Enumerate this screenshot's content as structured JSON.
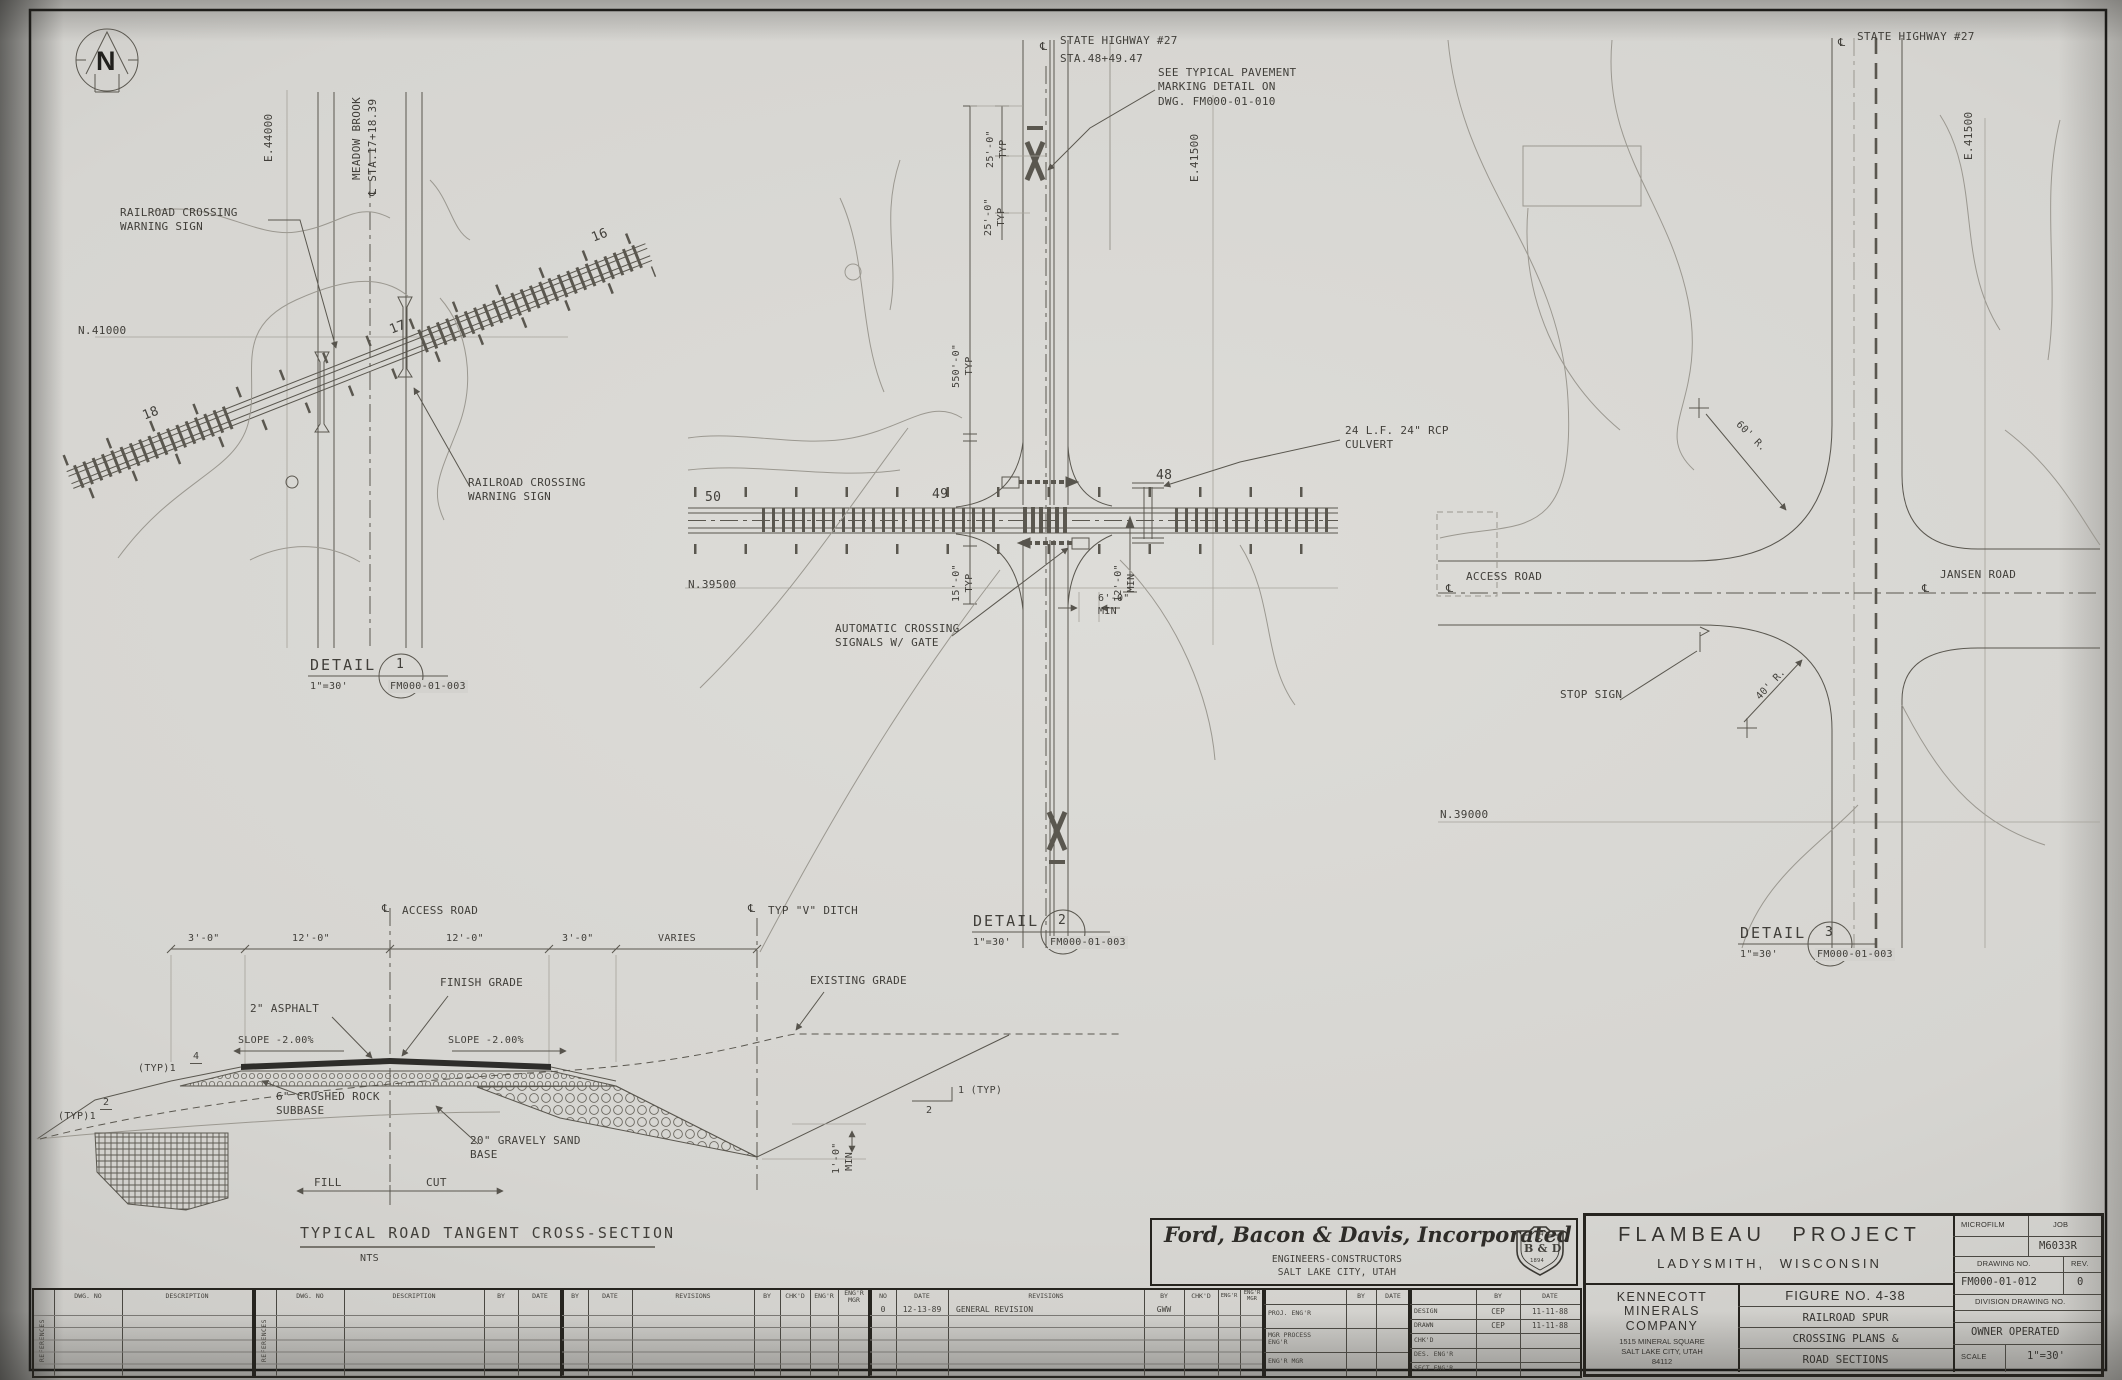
{
  "sheet": {
    "north_letter": "N"
  },
  "d1": {
    "grid_e": "E.44000",
    "grid_n": "N.41000",
    "brook": "MEADOW BROOK",
    "brook_sta": "STA.17+18.39",
    "warn": "RAILROAD CROSSING\nWARNING SIGN",
    "warn2": "RAILROAD CROSSING\nWARNING SIGN",
    "sta18": "18",
    "sta17": "17",
    "sta16": "16"
  },
  "d2": {
    "hwy": "STATE HIGHWAY #27",
    "hwy_sta": "STA.48+49.47",
    "note": "SEE TYPICAL PAVEMENT\nMARKING DETAIL ON\nDWG. FM000-01-010",
    "dim25a": "25'-0\"\nTYP",
    "dim25b": "25'-0\"\nTYP",
    "grid_e": "E.41500",
    "grid_n": "N.39500",
    "dim550": "550'-0\"\nTYP",
    "dim15": "15'-0\"\nTYP",
    "dim12": "12'-0\"\nMIN",
    "dim6": "6'-0\"\nMIN",
    "culvert": "24 L.F. 24\" RCP\nCULVERT",
    "signals": "AUTOMATIC CROSSING\nSIGNALS W/ GATE",
    "sta50": "50",
    "sta49": "49",
    "sta48": "48"
  },
  "d3": {
    "hwy": "STATE HIGHWAY #27",
    "grid_e": "E.41500",
    "grid_n": "N.39000",
    "r60": "60' R.",
    "r40": "40' R.",
    "access": "ACCESS ROAD",
    "jansen": "JANSEN ROAD",
    "stop": "STOP SIGN"
  },
  "xs": {
    "cl_access": "ACCESS ROAD",
    "cl_ditch": "TYP \"V\" DITCH",
    "dim1": "3'-0\"",
    "dim2": "12'-0\"",
    "dim3": "12'-0\"",
    "dim4": "3'-0\"",
    "dim5": "VARIES",
    "finish": "FINISH GRADE",
    "asphalt": "2\" ASPHALT",
    "slope_l": "SLOPE -2.00%",
    "slope_r": "SLOPE -2.00%",
    "typ4_label": "(TYP)1",
    "typ4_num": "4",
    "typ2_label": "(TYP)1",
    "typ2_num": "2",
    "subbase": "6\" CRUSHED ROCK\nSUBBASE",
    "base": "20\" GRAVELY SAND\nBASE",
    "fill": "FILL",
    "cut": "CUT",
    "existing": "EXISTING GRADE",
    "cut_slope_h": "1 (TYP)",
    "cut_slope_v": "2",
    "ditch_dim": "1'-0\"\nMIN.",
    "title": "TYPICAL ROAD TANGENT CROSS-SECTION",
    "scale_note": "NTS"
  },
  "callouts": {
    "label": "DETAIL",
    "scale": "1\"=30'",
    "ref": "FM000-01-003",
    "n1": "1",
    "n2": "2",
    "n3": "3"
  },
  "tb": {
    "firm": {
      "name": "Ford, Bacon & Davis, Incorporated",
      "sub1": "ENGINEERS-CONSTRUCTORS",
      "sub2": "SALT LAKE CITY, UTAH",
      "shield1": "F",
      "shield2": "B & D",
      "shield3": "1894"
    },
    "project": {
      "name": "FLAMBEAU PROJECT",
      "loc": "LADYSMITH, WISCONSIN"
    },
    "owner": {
      "name": "KENNECOTT\nMINERALS\nCOMPANY",
      "addr": "1515 MINERAL SQUARE\nSALT LAKE CITY, UTAH\n84112"
    },
    "figure": {
      "r1": "FIGURE NO. 4-38",
      "r2": "RAILROAD SPUR",
      "r3": "CROSSING PLANS &",
      "r4": "ROAD SECTIONS"
    },
    "meta": {
      "microfilm": "MICROFILM",
      "job": "JOB",
      "job_no": "M6033R",
      "dwg_label": "DRAWING NO.",
      "rev_label": "REV.",
      "dwg_no": "FM000-01-012",
      "rev": "0",
      "division": "DIVISION DRAWING NO.",
      "owner_op": "OWNER OPERATED",
      "scale_label": "SCALE",
      "scale": "1\"=30'"
    },
    "stamp": {
      "by": "BY",
      "date": "DATE",
      "l1": "PROJ. ENG'R",
      "l2": "MGR PROCESS\nENG'R",
      "l3": "ENG'R MGR",
      "r1": "DESIGN",
      "r1by": "CEP",
      "r1date": "11-11-88",
      "r2": "DRAWN",
      "r2by": "CEP",
      "r2date": "11-11-88",
      "r3": "CHK'D",
      "r4": "DES. ENG'R",
      "r5": "SECT ENG'R"
    }
  },
  "refs": {
    "side": "REFERENCES",
    "dwg": "DWG. NO",
    "desc": "DESCRIPTION",
    "by": "BY",
    "date": "DATE"
  },
  "rev": {
    "no": "NO",
    "date": "DATE",
    "revisions": "REVISIONS",
    "by": "BY",
    "chkd": "CHK'D",
    "engr": "ENG'R",
    "engr_mgr": "ENG'R\nMGR",
    "e_no": "0",
    "e_date": "12-13-89",
    "e_desc": "GENERAL REVISION",
    "e_by": "GWW"
  }
}
